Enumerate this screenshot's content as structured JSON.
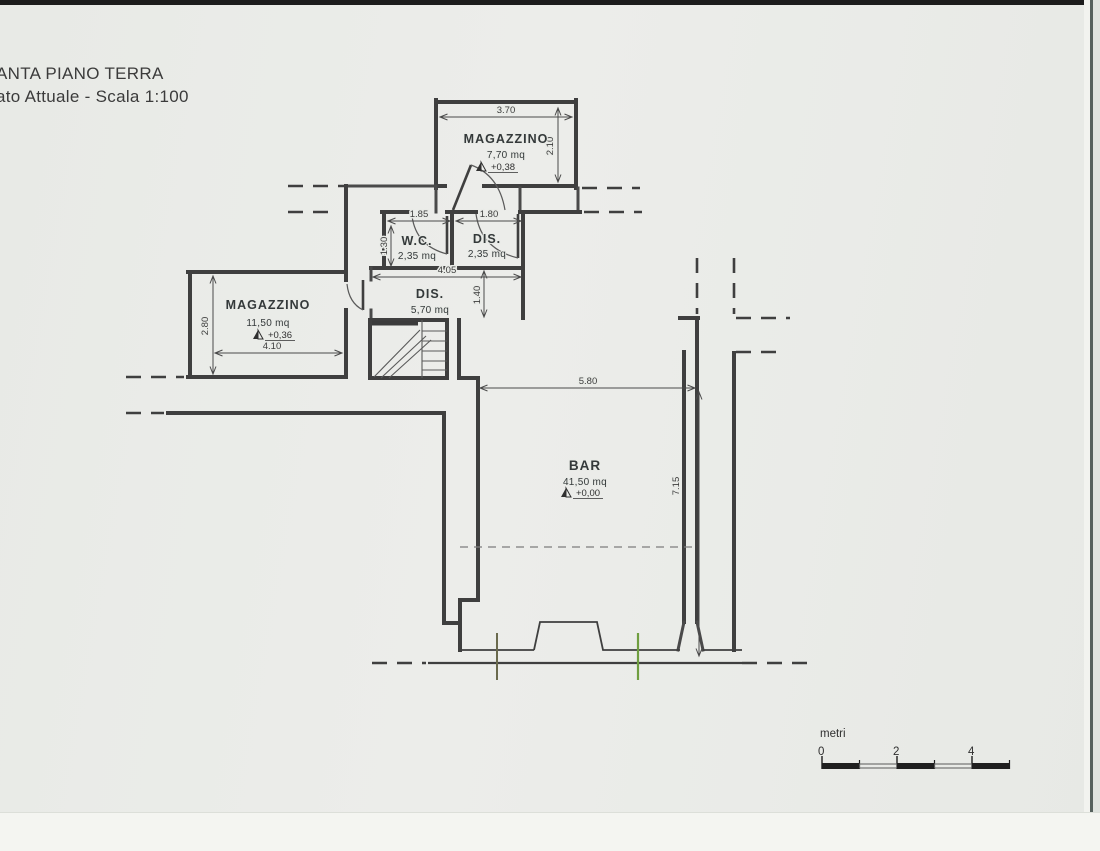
{
  "title": {
    "line1": "ANTA PIANO TERRA",
    "line2": "ato Attuale - Scala 1:100"
  },
  "rooms": {
    "magazzino_top": {
      "name": "MAGAZZINO",
      "area": "7,70 mq",
      "level": "+0,38",
      "width_dim": "3.70",
      "height_dim": "2.10"
    },
    "wc": {
      "name": "W.C.",
      "area": "2,35 mq",
      "width_dim": "1.85",
      "height_dim": "1.30"
    },
    "dis_small": {
      "name": "DIS.",
      "area": "2,35 mq",
      "width_dim": "1.80"
    },
    "dis_corridor": {
      "name": "DIS.",
      "area": "5,70 mq",
      "width_dim": "4.05",
      "height_dim": "1.40"
    },
    "magazzino_left": {
      "name": "MAGAZZINO",
      "area": "11,50 mq",
      "level": "+0,36",
      "width_dim": "4.10",
      "height_dim": "2.80"
    },
    "bar": {
      "name": "BAR",
      "area": "41,50 mq",
      "level": "+0,00",
      "width_dim": "5.80",
      "height_dim": "7.15"
    }
  },
  "scale_bar": {
    "label": "metri",
    "tick0": "0",
    "tick2": "2",
    "tick4": "4"
  },
  "colors": {
    "wall": "#3f3f3f",
    "paper": "#e9ebe7",
    "accent_green": "#6f9e3f",
    "tick_olive": "#6a6a4d",
    "dim": "#4a4a4a"
  }
}
